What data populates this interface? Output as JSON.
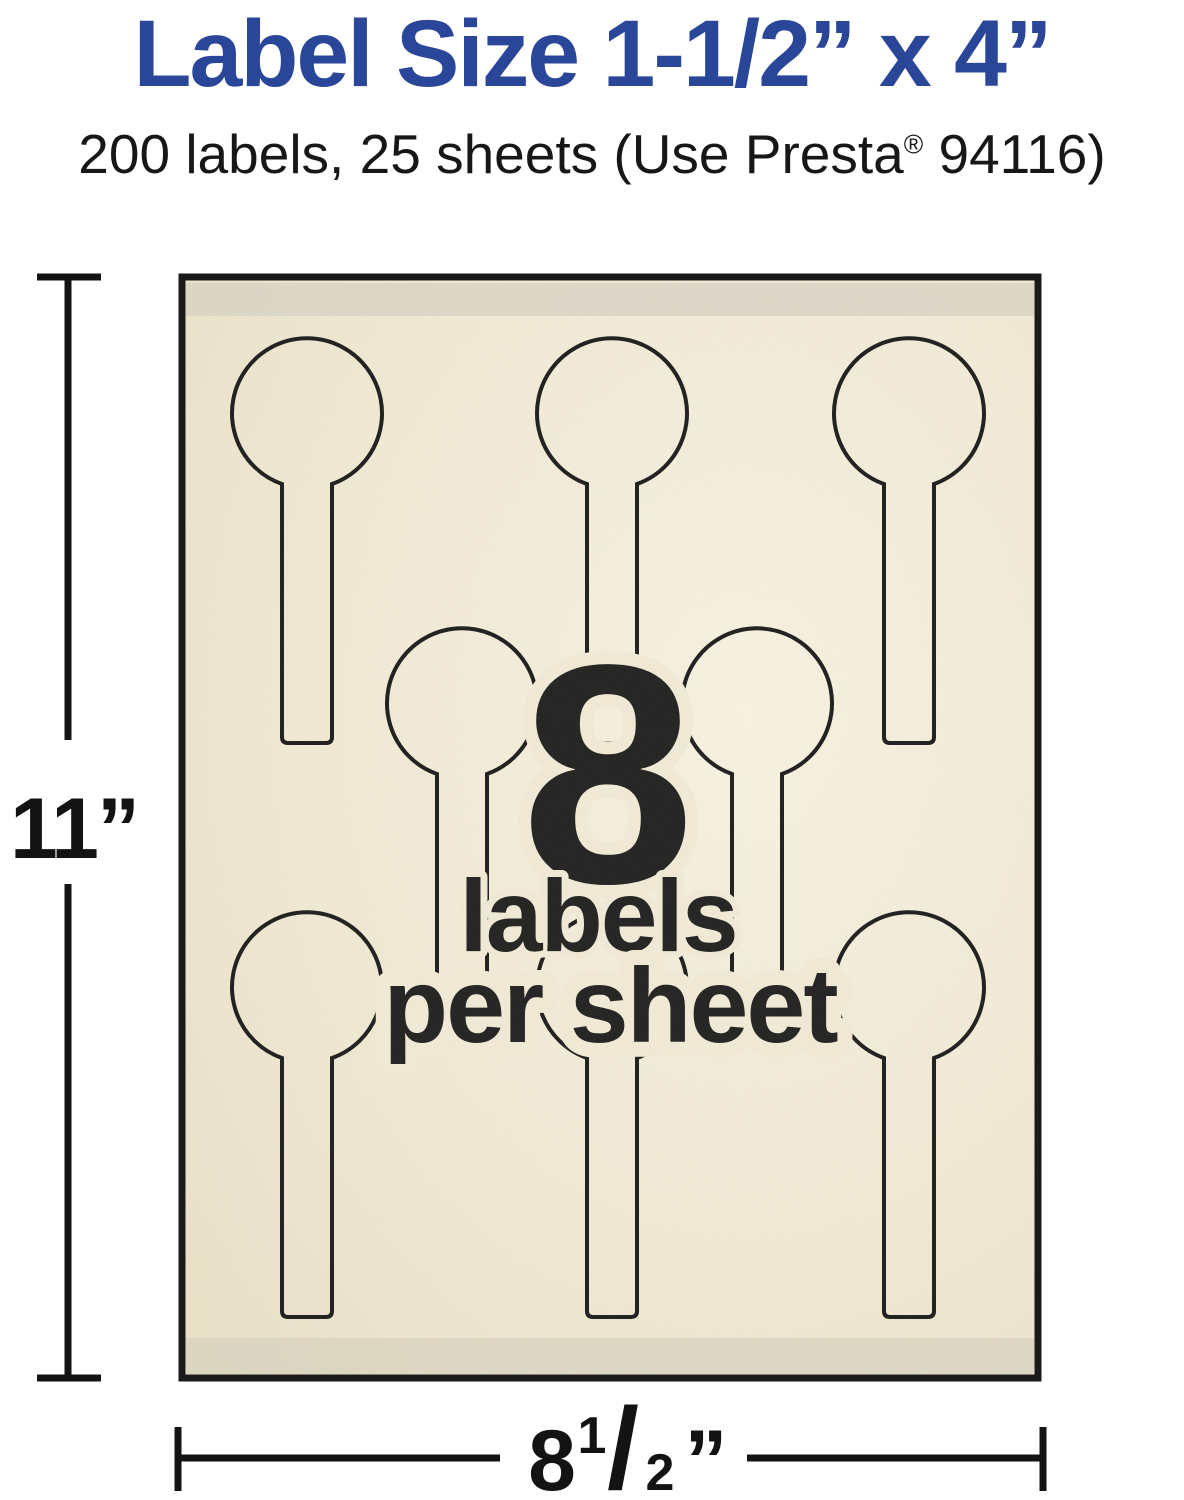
{
  "header": {
    "title": "Label Size 1-1/2” x 4”",
    "subtitle_before_reg": "200 labels, 25 sheets (Use Presta",
    "subtitle_reg_mark": "®",
    "subtitle_after_reg": " 94116)",
    "title_color": "#2a4699",
    "subtitle_color": "#171717"
  },
  "sheet": {
    "center_number": "8",
    "center_line1": "labels",
    "center_line2": "per sheet",
    "labels_per_sheet": 8,
    "label_shape": "lollipop-tag",
    "rows": [
      {
        "row": "top",
        "label_count": 3
      },
      {
        "row": "middle",
        "label_count": 2
      },
      {
        "row": "bottom",
        "label_count": 3
      }
    ],
    "colors": {
      "paper_cream": "#f2ebd7",
      "paper_highlight": "#f8f3e3",
      "paper_shadow": "#ebe1c9",
      "strip_gray": "#d7d3c4",
      "outline_dark": "#1b1b1b",
      "border_dark": "#1a1a1a"
    }
  },
  "dimensions": {
    "height_label": "11”",
    "width_whole": "8",
    "width_frac_numerator": "1",
    "width_frac_slash": "/",
    "width_frac_denominator": "2",
    "width_unit": "”",
    "line_color": "#131313"
  }
}
